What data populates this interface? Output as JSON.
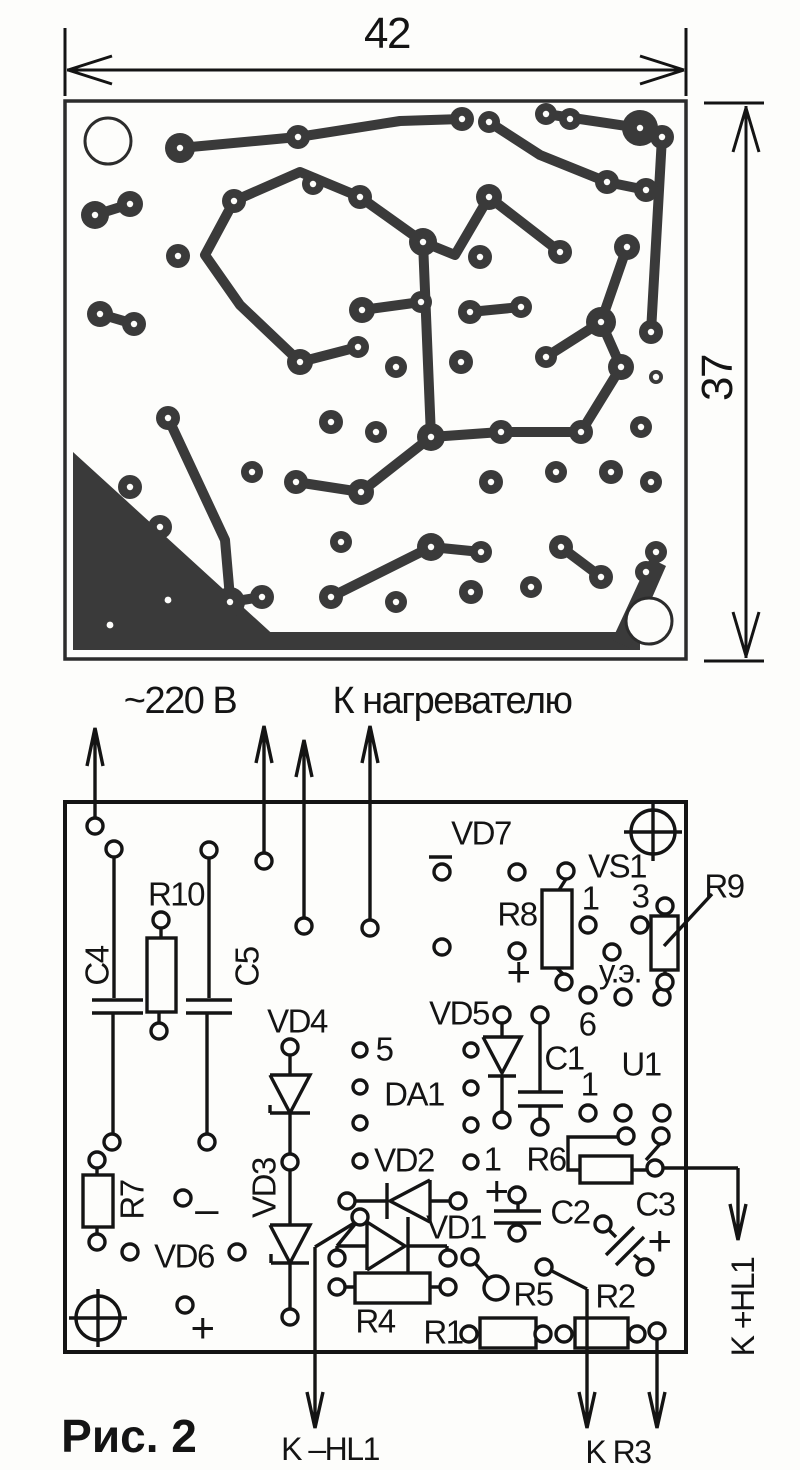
{
  "caption": "Рис. 2",
  "dimensions": {
    "width": "42",
    "height": "37"
  },
  "connections": {
    "mains": "~220 В",
    "heater": "К нагревателю",
    "hl1_plus": "K +HL1",
    "hl1_minus": "K –HL1",
    "r3": "K R3"
  },
  "labels": {
    "c1": "C1",
    "c2": "C2",
    "c3": "C3",
    "c4": "C4",
    "c5": "C5",
    "r1": "R1",
    "r2": "R2",
    "r4": "R4",
    "r5": "R5",
    "r6": "R6",
    "r7": "R7",
    "r8": "R8",
    "r9": "R9",
    "r10": "R10",
    "vd1": "VD1",
    "vd2": "VD2",
    "vd3": "VD3",
    "vd4": "VD4",
    "vd5": "VD5",
    "vd6": "VD6",
    "vd7": "VD7",
    "vs1": "VS1",
    "da1": "DA1",
    "u1": "U1"
  },
  "pins": {
    "p1": "1",
    "p3": "3",
    "p5": "5",
    "p6": "6",
    "ue": "у.э."
  },
  "marks": {
    "plus": "+",
    "minus": "–"
  }
}
